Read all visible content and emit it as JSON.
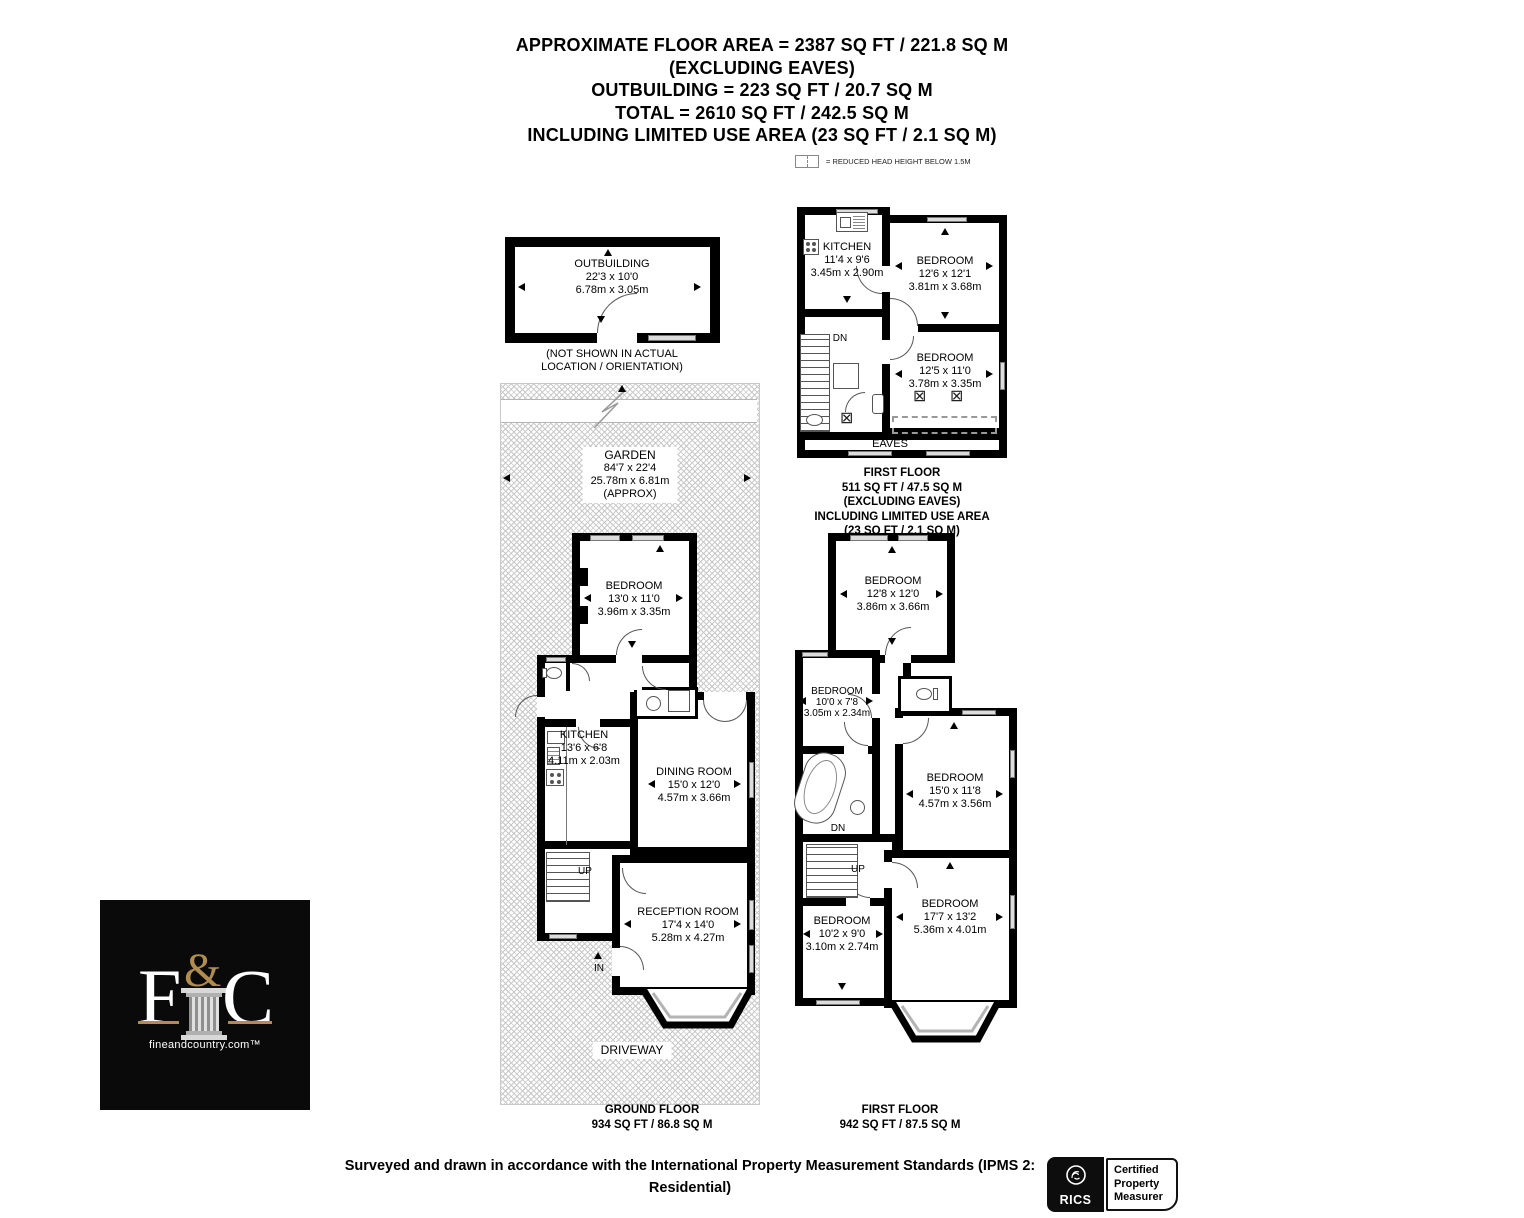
{
  "header": {
    "lines": [
      "APPROXIMATE FLOOR AREA = 2387 SQ FT / 221.8 SQ M",
      "(EXCLUDING EAVES)",
      "OUTBUILDING = 223 SQ FT / 20.7 SQ M",
      "TOTAL = 2610 SQ FT / 242.5 SQ M",
      "INCLUDING LIMITED USE AREA (23 SQ FT / 2.1 SQ M)"
    ]
  },
  "legend": {
    "label": "= REDUCED HEAD HEIGHT BELOW 1.5M"
  },
  "outbuilding": {
    "room": {
      "name": "OUTBUILDING",
      "dim_ft": "22'3 x 10'0",
      "dim_m": "6.78m x 3.05m"
    },
    "note_line1": "(NOT SHOWN IN ACTUAL",
    "note_line2": "LOCATION / ORIENTATION)"
  },
  "garden": {
    "name": "GARDEN",
    "dim_ft": "84'7 x 22'4",
    "dim_m": "25.78m x 6.81m",
    "approx": "(APPROX)"
  },
  "driveway_label": "DRIVEWAY",
  "ground_floor": {
    "caption": [
      "GROUND FLOOR",
      "934 SQ FT / 86.8 SQ M"
    ],
    "up_label": "UP",
    "in_label": "IN",
    "bedroom": {
      "name": "BEDROOM",
      "dim_ft": "13'0 x 11'0",
      "dim_m": "3.96m x 3.35m"
    },
    "kitchen": {
      "name": "KITCHEN",
      "dim_ft": "13'6 x 6'8",
      "dim_m": "4.11m x 2.03m"
    },
    "dining": {
      "name": "DINING ROOM",
      "dim_ft": "15'0 x 12'0",
      "dim_m": "4.57m x 3.66m"
    },
    "reception": {
      "name": "RECEPTION ROOM",
      "dim_ft": "17'4 x 14'0",
      "dim_m": "5.28m x 4.27m"
    }
  },
  "second_floor": {
    "caption": [
      "FIRST FLOOR",
      "511 SQ FT / 47.5 SQ M",
      "(EXCLUDING EAVES)",
      "INCLUDING LIMITED USE AREA",
      "(23 SQ FT / 2.1 SQ M)"
    ],
    "dn_label": "DN",
    "eaves_label": "EAVES",
    "kitchen": {
      "name": "KITCHEN",
      "dim_ft": "11'4 x 9'6",
      "dim_m": "3.45m x 2.90m"
    },
    "bedroom1": {
      "name": "BEDROOM",
      "dim_ft": "12'6 x 12'1",
      "dim_m": "3.81m x 3.68m"
    },
    "bedroom2": {
      "name": "BEDROOM",
      "dim_ft": "12'5 x 11'0",
      "dim_m": "3.78m x 3.35m"
    }
  },
  "first_floor": {
    "caption": [
      "FIRST FLOOR",
      "942 SQ FT / 87.5 SQ M"
    ],
    "dn_label": "DN",
    "up_label": "UP",
    "bedroom1": {
      "name": "BEDROOM",
      "dim_ft": "12'8 x 12'0",
      "dim_m": "3.86m x 3.66m"
    },
    "bedroom2": {
      "name": "BEDROOM",
      "dim_ft": "10'0 x 7'8",
      "dim_m": "3.05m x 2.34m"
    },
    "bedroom3": {
      "name": "BEDROOM",
      "dim_ft": "15'0 x 11'8",
      "dim_m": "4.57m x 3.56m"
    },
    "bedroom4": {
      "name": "BEDROOM",
      "dim_ft": "10'2 x 9'0",
      "dim_m": "3.10m x 2.74m"
    },
    "bedroom5": {
      "name": "BEDROOM",
      "dim_ft": "17'7 x 13'2",
      "dim_m": "5.36m x 4.01m"
    }
  },
  "logo": {
    "letter_f": "F",
    "ampersand": "&",
    "letter_c": "C",
    "website": "fineandcountry.com™",
    "gold_color": "#b08c4e",
    "background": "#0a0a0a"
  },
  "footer": {
    "disclaimer_line1": "Surveyed and drawn in accordance with the International Property Measurement Standards (IPMS 2:",
    "disclaimer_line2": "Residential)",
    "rics_label": "RICS",
    "certified_lines": [
      "Certified",
      "Property",
      "Measurer"
    ]
  }
}
